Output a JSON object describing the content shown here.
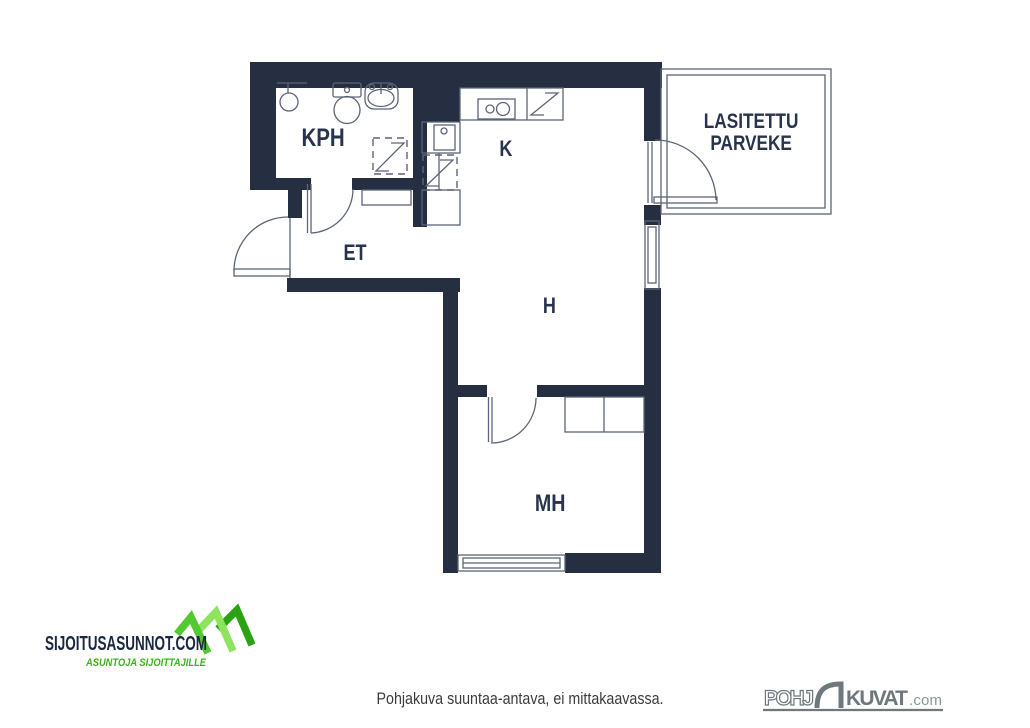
{
  "plan": {
    "rooms": {
      "kph": "KPH",
      "et": "ET",
      "k": "K",
      "h": "H",
      "mh": "MH"
    },
    "balcony": {
      "line1": "LASITETTU",
      "line2": "PARVEKE"
    }
  },
  "footer": {
    "disclaimer": "Pohjakuva suuntaa-antava, ei mittakaavassa."
  },
  "branding": {
    "sijoitusasunnot": {
      "title": "SIJOITUSASUNNOT.COM",
      "tagline": "ASUNTOJA SIJOITTAJILLE"
    },
    "pohjakuvat": {
      "part1": "POHJ",
      "part2": "KUVAT",
      "suffix": ".com"
    }
  },
  "colors": {
    "wall": "#262e42",
    "thin_line": "#5c6577",
    "room_label": "#28334e",
    "logo_navy": "#1b2740",
    "logo_green_mid": "#52c930",
    "logo_green_light": "#8ee35f",
    "logo_green_dark": "#2aa313",
    "pohjakuvat_gray": "#6e787d",
    "disclaimer_text": "#3b3b3b"
  }
}
